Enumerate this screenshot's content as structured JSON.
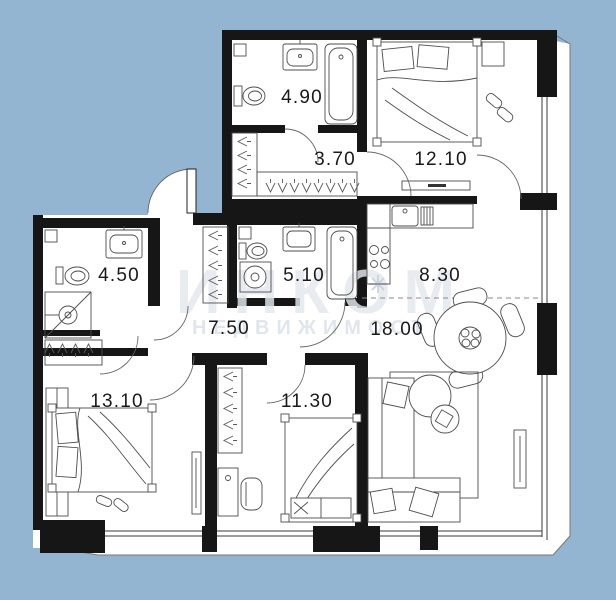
{
  "watermark": {
    "line1": "ИНКОМ",
    "line2": "НЕДВИЖИМОСТЬ"
  },
  "rooms": [
    {
      "id": "bathroom-top",
      "area": "4.90"
    },
    {
      "id": "wardrobe-hall-top",
      "area": "3.70"
    },
    {
      "id": "bedroom-top",
      "area": "12.10"
    },
    {
      "id": "bathroom-left",
      "area": "4.50"
    },
    {
      "id": "bathroom-middle",
      "area": "5.10"
    },
    {
      "id": "kitchen",
      "area": "8.30"
    },
    {
      "id": "hallway",
      "area": "7.50"
    },
    {
      "id": "living-room",
      "area": "18.00"
    },
    {
      "id": "bedroom-left",
      "area": "13.10"
    },
    {
      "id": "bedroom-middle",
      "area": "11.30"
    }
  ],
  "colors": {
    "background": "#93b5d2",
    "walls": "#161616",
    "floor": "#ffffff",
    "watermark": "#e3e9ee"
  }
}
